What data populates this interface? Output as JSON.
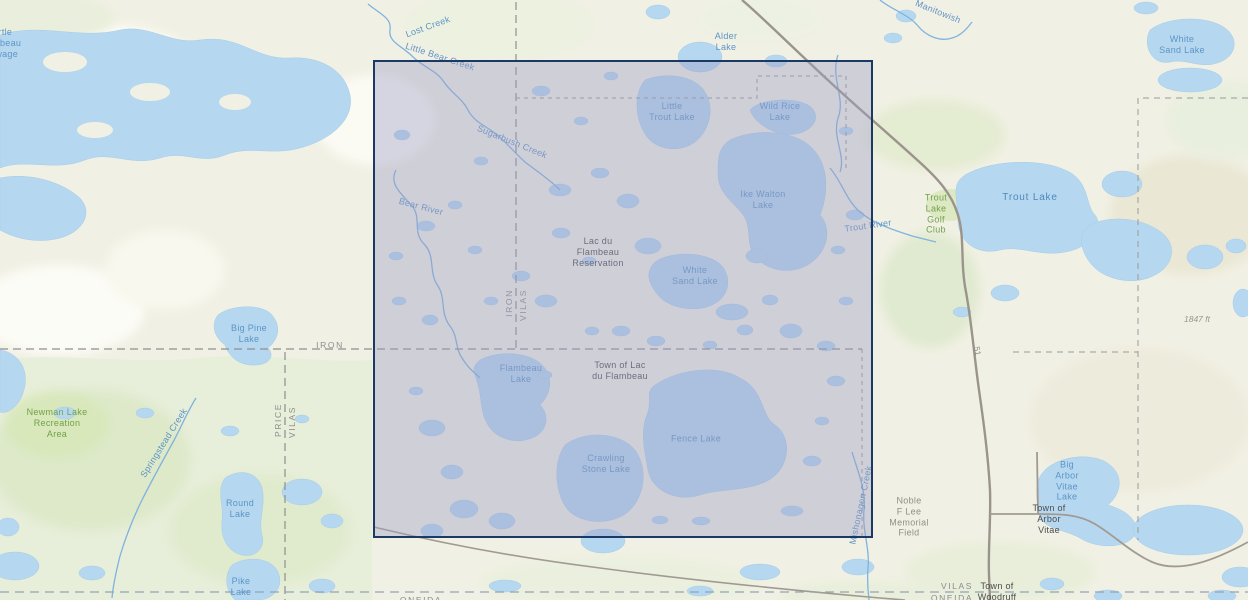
{
  "map": {
    "type": "topographic-basemap",
    "region": "Lac du Flambeau, Vilas County, Wisconsin",
    "labels": {
      "turtle_flambeau_flowage": "Turtle\nFlambeau\nFlowage",
      "lost_creek": "Lost Creek",
      "little_bear_creek": "Little Bear Creek",
      "sugarbush_creek": "Sugarbush Creek",
      "alder_lake": "Alder\nLake",
      "manitowish_river": "Manitowish",
      "white_sand_lake_ne": "White\nSand Lake",
      "little_trout_lake": "Little\nTrout Lake",
      "wild_rice_lake": "Wild Rice\nLake",
      "ike_walton_lake": "Ike Walton\nLake",
      "trout_river": "Trout River",
      "trout_lake_golf_club": "Trout\nLake\nGolf\nClub",
      "trout_lake": "Trout Lake",
      "lac_du_flambeau_reservation": "Lac du\nFlambeau\nReservation",
      "white_sand_lake_center": "White\nSand Lake",
      "bear_river": "Bear River",
      "iron_vertical": "IRON",
      "vilas_vertical": "VILAS",
      "iron_horizontal": "IRON",
      "big_pine_lake": "Big Pine\nLake",
      "price_vertical": "PRICE",
      "vilas_vertical_2": "VILAS",
      "newman_lake_recreation_area": "Newman Lake\nRecreation\nArea",
      "springstead_creek": "Springstead Creek",
      "flambeau_lake": "Flambeau\nLake",
      "town_of_lac_du_flambeau": "Town of Lac\ndu Flambeau",
      "fence_lake": "Fence Lake",
      "crawling_stone_lake": "Crawling\nStone Lake",
      "round_lake": "Round\nLake",
      "pike_lake": "Pike\nLake",
      "mishonagon_creek": "Mishonagon Creek",
      "noble_f_lee_memorial_field": "Noble\nF Lee\nMemorial\nField",
      "big_arbor_vitae_lake": "Big\nArbor\nVitae\nLake",
      "town_of_arbor_vitae": "Town of\nArbor\nVitae",
      "elevation_1847": "1847 ft",
      "vilas_county_south": "VILAS",
      "oneida_county": "ONEIDA",
      "town_of_woodruff": "Town of\nWoodruff",
      "oneida_bottom_left": "ONEIDA",
      "highway_51": "51"
    },
    "colors": {
      "selection_border": "#1b3a63",
      "selection_fill_rgba": "rgba(158,158,198,0.40)",
      "water": "#b5d8f0",
      "land": "#f1f0e4",
      "forest": "#e7eed9",
      "road": "#a29a92",
      "boundary_dash": "#8f8f8f",
      "water_label": "#5d94c5",
      "town_label": "#4c4c4c",
      "county_label": "#8d8d8d",
      "green_label": "#72a14c"
    }
  }
}
